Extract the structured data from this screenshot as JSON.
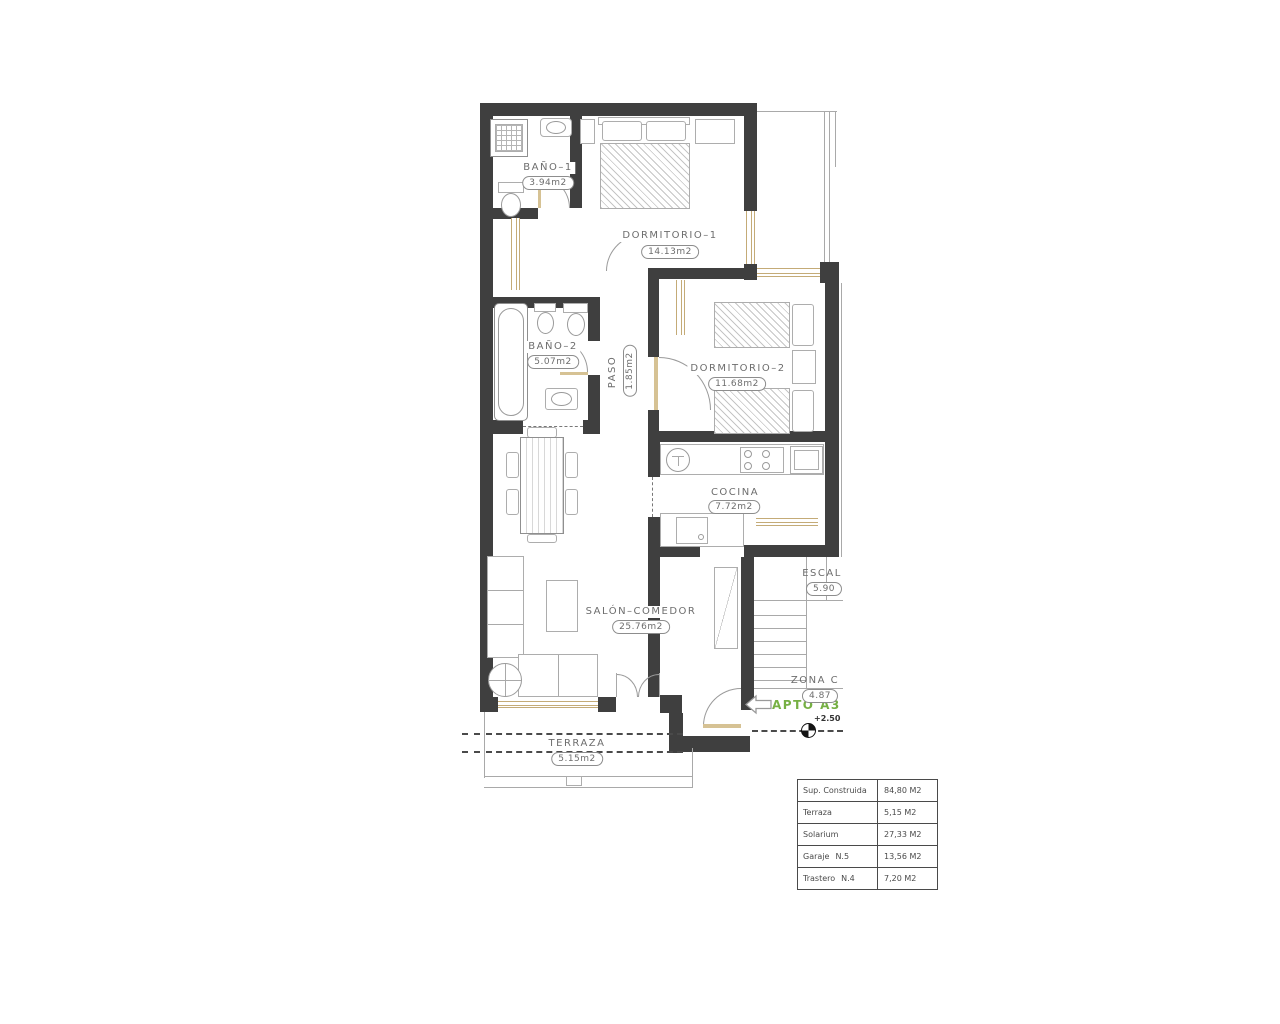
{
  "floorplan": {
    "rooms": {
      "banyo1": {
        "name": "BAÑO–1",
        "area": "3.94m2"
      },
      "dormitorio1": {
        "name": "DORMITORIO–1",
        "area": "14.13m2"
      },
      "banyo2": {
        "name": "BAÑO–2",
        "area": "5.07m2"
      },
      "paso": {
        "name": "PASO",
        "area": "1.85m2"
      },
      "dormitorio2": {
        "name": "DORMITORIO–2",
        "area": "11.68m2"
      },
      "cocina": {
        "name": "COCINA",
        "area": "7.72m2"
      },
      "salon": {
        "name": "SALÓN–COMEDOR",
        "area": "25.76m2"
      },
      "terraza": {
        "name": "TERRAZA",
        "area": "5.15m2"
      },
      "escalera": {
        "name": "ESCAL",
        "area": "5.90"
      },
      "zona_comun": {
        "name": "ZONA  C",
        "area": "4.87"
      }
    },
    "annotations": {
      "apartment": "APTO A3",
      "level": "+2.50"
    },
    "colors": {
      "wall": "#3f3f3f",
      "window_frame": "#c4ab77",
      "accent_green": "#76b043",
      "line": "#a9a9a9",
      "text": "#6d6d6d"
    }
  },
  "summary_table": {
    "rows": [
      {
        "label": "Sup. Construida",
        "unit": "",
        "value": "84,80 M2"
      },
      {
        "label": "Terraza",
        "unit": "",
        "value": "5,15 M2"
      },
      {
        "label": "Solarium",
        "unit": "",
        "value": "27,33 M2"
      },
      {
        "label": "Garaje",
        "unit": "N.5",
        "value": "13,56 M2"
      },
      {
        "label": "Trastero",
        "unit": "N.4",
        "value": "7,20 M2"
      }
    ]
  }
}
